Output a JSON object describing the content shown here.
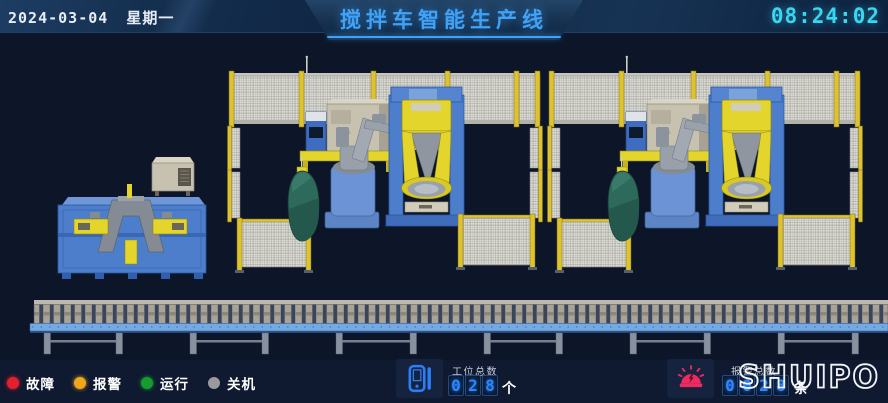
{
  "header": {
    "date": "2024-03-04",
    "weekday": "星期一",
    "title": "搅拌车智能生产线",
    "time": "08:24:02"
  },
  "legend": {
    "items": [
      {
        "label": "故障"
      },
      {
        "label": "报警"
      },
      {
        "label": "运行"
      },
      {
        "label": "关机"
      }
    ]
  },
  "counters": {
    "stations": {
      "label": "工位总数",
      "digits": [
        "0",
        "2",
        "8"
      ],
      "unit": "个"
    },
    "alarms": {
      "label": "报警总数",
      "digits": [
        "0",
        "0",
        "2",
        "8"
      ],
      "unit": "条"
    }
  },
  "logo": {
    "text": "SHUIPO"
  },
  "scene": {
    "robot_brand_label": "KUKA",
    "cell_count": 2
  },
  "colors": {
    "bg_scene": "#0c1628",
    "bg_bottom": "#0f1930",
    "accent_blue": "#3fa2f7",
    "time_cyan": "#38d6f0",
    "digit_blue": "#2e86ff",
    "panel_bg": "#16233f",
    "status_fault": "#e5202e",
    "status_alarm": "#f0a71c",
    "status_run": "#169c2e",
    "status_off": "#9a9a9a",
    "fence_yellow": "#dec32f",
    "robot_yellow": "#e3d52b",
    "machine_blue": "#4c7ecb",
    "tank_green": "#2e6a5c",
    "cabinet_beige": "#c7c1b0",
    "conveyor_beam": "#74a9e2",
    "conveyor_leg": "#87919f",
    "siren_pink": "#ef2a60",
    "logo_white": "#f2f4f8"
  }
}
